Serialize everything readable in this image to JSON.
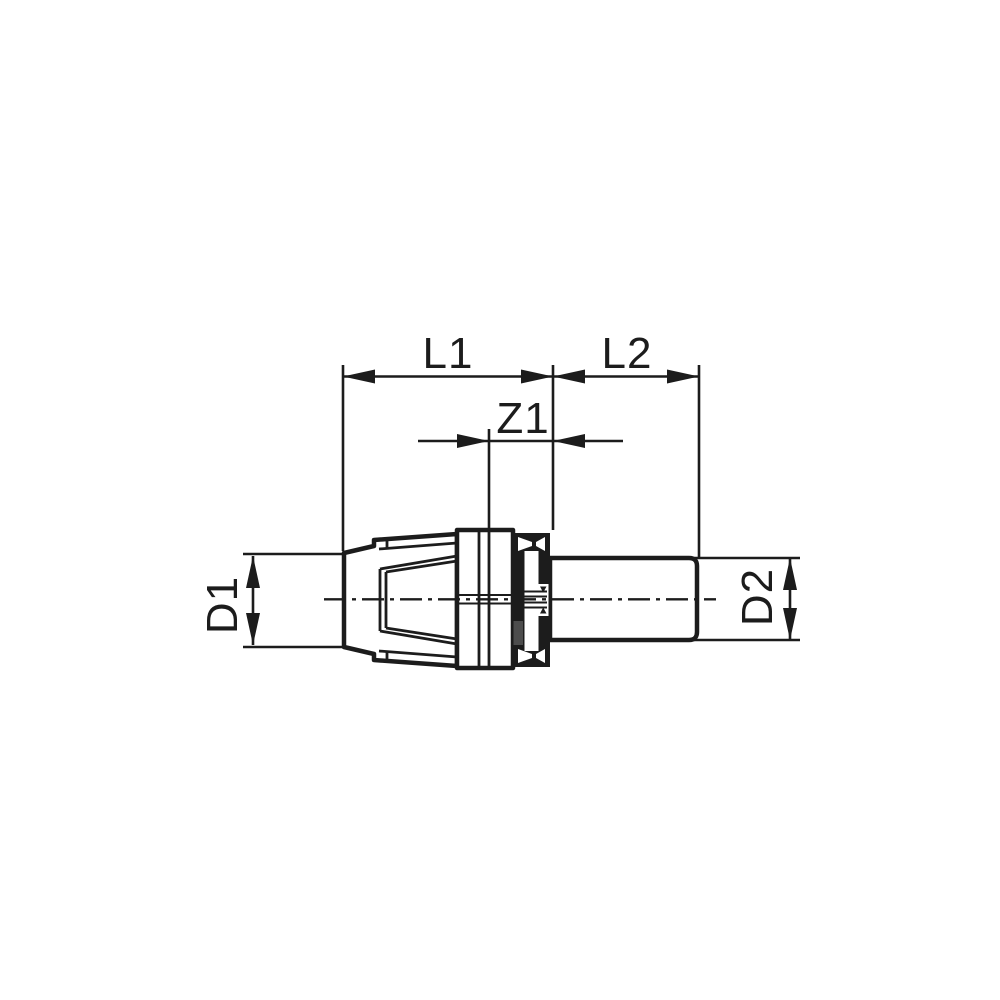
{
  "drawing": {
    "labels": {
      "l1": "L1",
      "l2": "L2",
      "z1": "Z1",
      "d1": "D1",
      "d2": "D2"
    },
    "colors": {
      "ink": "#1c1c1c",
      "background": "#ffffff",
      "shade_patch": "#4d4d4d"
    }
  }
}
